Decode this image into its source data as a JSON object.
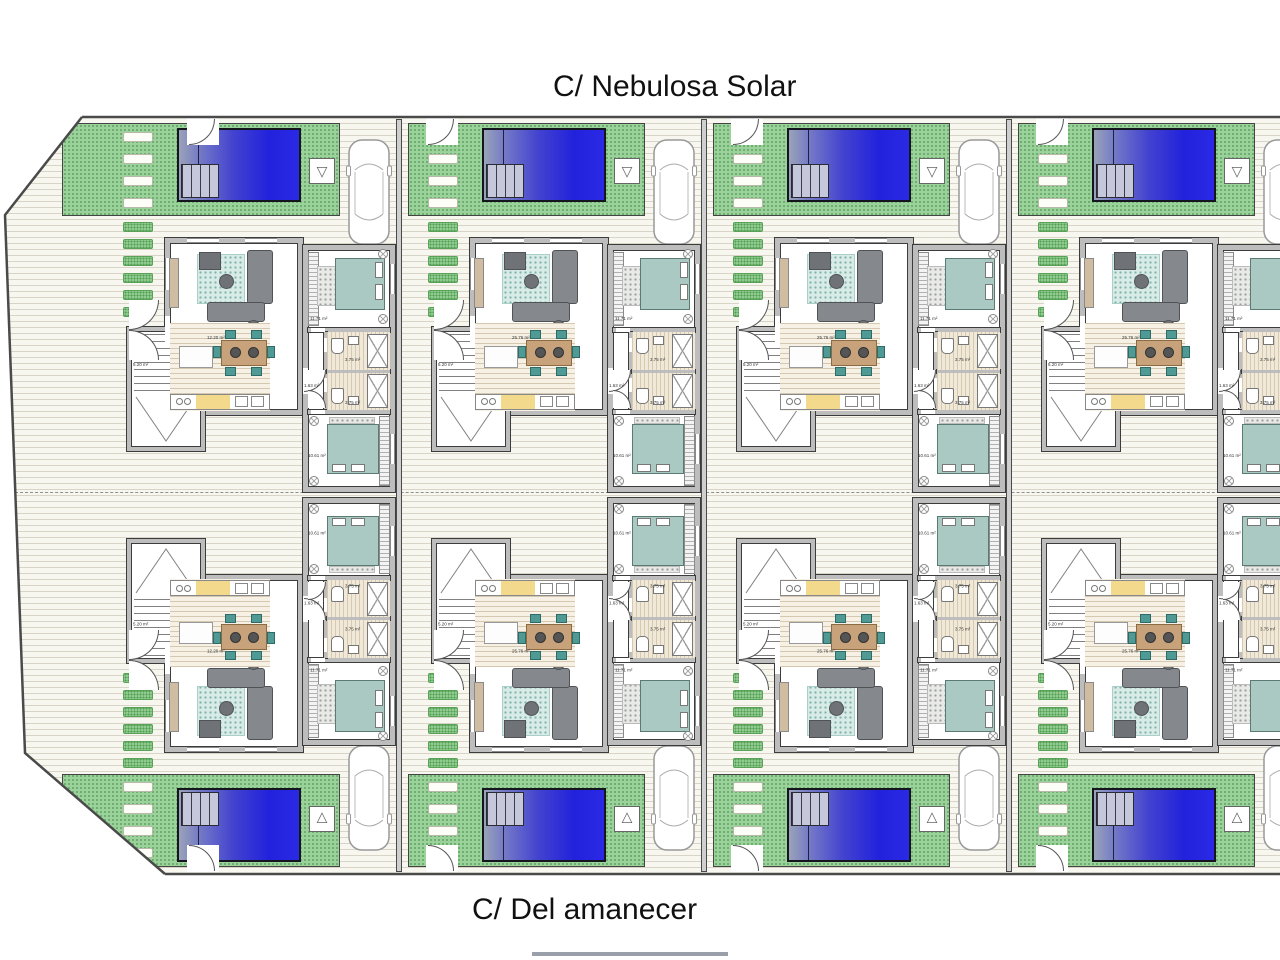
{
  "streets": {
    "top": "C/ Nebulosa Solar",
    "bottom": "C/ Del amanecer"
  },
  "rooms": {
    "porch": "5.20 m²",
    "bedroom_main": "11.71 m²",
    "bathroom": "3.75 m²",
    "hallway": "1.63 m²",
    "bedroom_second": "10.61 m²"
  },
  "units": [
    {
      "id": "villa-1-north",
      "column": 1,
      "row": "top",
      "living_label": "12.20 m²"
    },
    {
      "id": "villa-2-north",
      "column": 2,
      "row": "top",
      "living_label": "25.76 m²"
    },
    {
      "id": "villa-3-north",
      "column": 3,
      "row": "top",
      "living_label": "25.76 m²"
    },
    {
      "id": "villa-4-north",
      "column": 4,
      "row": "top",
      "living_label": "25.76 m²"
    },
    {
      "id": "villa-1-south",
      "column": 1,
      "row": "bottom",
      "living_label": "12.20 m²"
    },
    {
      "id": "villa-2-south",
      "column": 2,
      "row": "bottom",
      "living_label": "25.76 m²"
    },
    {
      "id": "villa-3-south",
      "column": 3,
      "row": "bottom",
      "living_label": "25.76 m²"
    },
    {
      "id": "villa-4-south",
      "column": 4,
      "row": "bottom",
      "living_label": "25.76 m²"
    }
  ],
  "icons": {
    "shower_glyph": "▽"
  },
  "colors": {
    "pool_blue": "#2222dc",
    "garden_green": "#9bd19b",
    "bed_teal": "#a9c9c2",
    "chair_teal": "#4f9a94",
    "table_wood": "#c8a27a",
    "kitchen_yellow": "#f2d98c",
    "wall_gray": "#bdbdbd",
    "terrace_cream": "#f7f6ef"
  }
}
